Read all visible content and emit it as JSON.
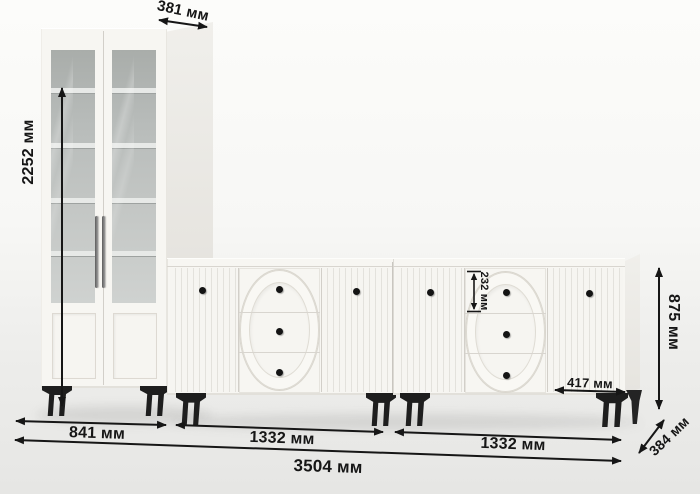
{
  "meta": {
    "units": "мм",
    "language": "ru",
    "scene": "furniture-set-dimension-diagram"
  },
  "colors": {
    "dimension_ink": "#161616",
    "furniture_white": "#f7f6f2",
    "legs_black": "#1e1e1e",
    "glass_interior_gray": "#b8bcba",
    "background_top": "#fcfcfa",
    "background_bottom": "#e6e6e4"
  },
  "furniture": {
    "cabinet": {
      "type": "display-cabinet",
      "glass_doors": 2,
      "shelves_per_door": 4
    },
    "sideboard_left": {
      "type": "sideboard",
      "doors": 2,
      "drawers": 3
    },
    "sideboard_right": {
      "type": "sideboard",
      "doors": 2,
      "drawers": 3
    }
  },
  "dimensions": {
    "cabinet_depth": "381 мм",
    "cabinet_height": "2252 мм",
    "cabinet_width": "841 мм",
    "sideboard1_width": "1332 мм",
    "sideboard2_width": "1332 мм",
    "total_width": "3504 мм",
    "sideboard_height": "875 мм",
    "sideboard_depth": "384 мм",
    "drawer_height": "232 мм",
    "door_width": "417 мм"
  }
}
